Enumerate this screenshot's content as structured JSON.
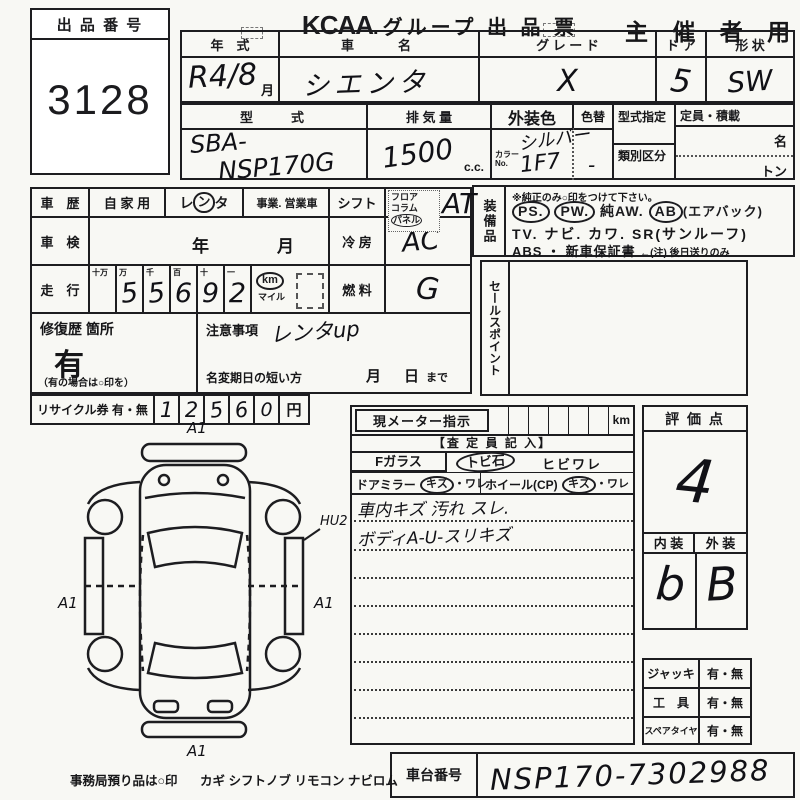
{
  "header": {
    "exhibit_no_label": "出 品 番 号",
    "exhibit_no": "3128",
    "title_logo": "KCAA",
    "title_rest": ".グループ 出 品 票",
    "audience": "主 催 者 用"
  },
  "row1": {
    "year_label": "年　式",
    "year_value": "R4/8",
    "month_unit": "月",
    "name_label": "車　　名",
    "name_value": "シエンタ",
    "grade_label": "グ レ ー ド",
    "grade_value": "X",
    "door_label": "ド ア",
    "door_value": "5",
    "shape_label": "形 状",
    "shape_value": "SW"
  },
  "row2": {
    "model_label": "型　　式",
    "model_value_1": "SBA-",
    "model_value_2": "NSP170G",
    "disp_label": "排 気 量",
    "disp_value": "1500",
    "disp_unit": "c.c.",
    "color_label": "外装色",
    "color_value": "シルバー",
    "color_no_label_1": "カラー",
    "color_no_label_2": "No.",
    "color_no_value": "1F7",
    "recolor_label": "色替",
    "recolor_value": "-",
    "type_desig_label": "型式指定",
    "class_label": "類別区分",
    "capacity_label": "定員・積載",
    "capacity_persons": "名",
    "capacity_tons": "トン"
  },
  "history": {
    "label": "車　歴",
    "opt_private": "自 家 用",
    "opt_rental_1": "レ",
    "opt_rental_2": "ン",
    "opt_rental_3": "タ",
    "opt_business": "事業. 営業車"
  },
  "shift": {
    "label": "シフト",
    "opt1": "フロア",
    "opt2": "コラム",
    "opt3": "パネル",
    "value": "AT"
  },
  "inspection": {
    "label": "車　検",
    "year_unit": "年",
    "month_unit": "月"
  },
  "aircon": {
    "label": "冷 房",
    "value": "AC"
  },
  "mileage": {
    "label": "走　行",
    "headers": [
      "十万",
      "万",
      "千",
      "百",
      "十",
      "一"
    ],
    "digits": [
      "",
      "5",
      "5",
      "6",
      "9",
      "2"
    ],
    "unit": "km",
    "unit_alt": "マイル"
  },
  "fuel": {
    "label": "燃 料",
    "value": "G"
  },
  "repair": {
    "label": "修復歴 箇所",
    "value": "有",
    "note": "（有の場合は○印を）"
  },
  "caution": {
    "label": "注意事項",
    "value": "レンタup",
    "rename_label": "名変期日の短い方",
    "month": "月",
    "day": "日",
    "until": "まで"
  },
  "recycle": {
    "label": "リサイクル券 有・無",
    "digits": [
      "1",
      "2",
      "5",
      "6",
      "0"
    ],
    "unit": "円"
  },
  "equipment": {
    "label": "装備品",
    "note": "※純正のみ○印をつけて下さい。",
    "ps": "PS.",
    "pw": "PW.",
    "aw": "純AW.",
    "ab": "AB",
    "ab_note": "(エアバック)",
    "line2": "TV. ナビ. カワ. SR(サンルーフ)",
    "line3": "ABS ・ 新車保証書",
    "line3_note": "←(注) 後日送りのみ"
  },
  "sales_point": {
    "label": "セールスポイント"
  },
  "meter": {
    "label": "現メーター指示",
    "unit": "km"
  },
  "assessor": {
    "title": "【査 定 員 記 入】",
    "fglass": "Fガラス",
    "opt_stone": "トビ石",
    "opt_crack": "ヒビワレ",
    "mirror": "ドアミラー",
    "mirror_kizu": "キズ",
    "mirror_ware": "・ワレ",
    "wheel": "ホイール(CP)",
    "wheel_kizu": "キズ",
    "wheel_ware": "・ワレ",
    "comment1": "車内キズ 汚れ スレ.",
    "comment2": "ボディA-U-スリキズ"
  },
  "score": {
    "label": "評 価 点",
    "value": "4",
    "interior_label": "内 装",
    "interior_value": "b",
    "exterior_label": "外 装",
    "exterior_value": "B"
  },
  "accessories": [
    {
      "label": "ジャッキ",
      "options": "有・無"
    },
    {
      "label": "工　具",
      "options": "有・無"
    },
    {
      "label": "スペアタイヤ",
      "options": "有・無"
    }
  ],
  "chassis": {
    "label": "車台番号",
    "value": "NSP170-7302988"
  },
  "footer": {
    "custody": "事務局預り品は○印",
    "items": "カギ シフトノブ リモコン ナビロム"
  },
  "diagram": {
    "a1": "A1",
    "hu2": "HU2"
  }
}
